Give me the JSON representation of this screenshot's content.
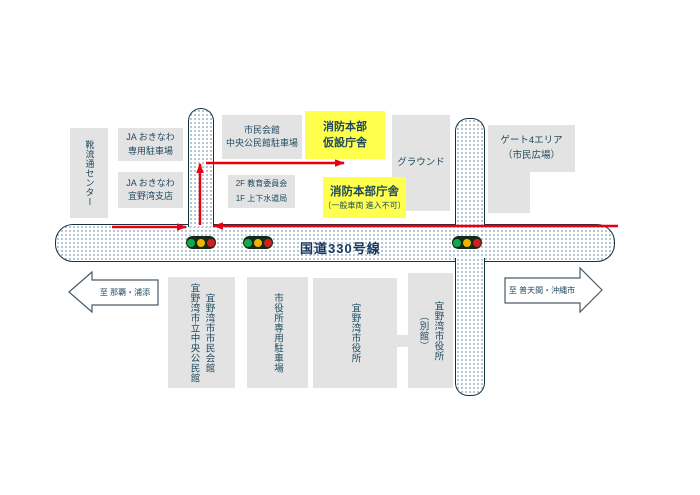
{
  "colors": {
    "highlight_yellow": "#ffff4d",
    "building_gray": "#e3e3e3",
    "route_arrow_red": "#e60012",
    "road_outline": "#16323e",
    "signal_green": "#11a94c",
    "signal_yellow": "#f2b300",
    "signal_red": "#cf1f1f",
    "text_navy": "#1f4a5e"
  },
  "labels": {
    "shoe_center": "靴流通センター",
    "ja_parking_l1": "JA おきなわ",
    "ja_parking_l2": "専用駐車場",
    "ja_branch_l1": "JA おきなわ",
    "ja_branch_l2": "宜野湾支店",
    "civic_hall_parking_l1": "市民会館",
    "civic_hall_parking_l2": "中央公民館駐車場",
    "fire_temp_l1": "消防本部",
    "fire_temp_l2": "仮設庁舎",
    "ground": "グラウンド",
    "gate4_l1": "ゲート4エリア",
    "gate4_l2": "（市民広場）",
    "floors_l1": "2F 教育委員会",
    "floors_l2": "1F 上下水道局",
    "fire_hq_l1": "消防本部庁舎",
    "fire_hq_l2": "（一般車両 進入不可）",
    "route": "国道330号線",
    "to_naha": "至 那覇・浦添",
    "to_futenma": "至 普天間・沖縄市",
    "civic_hall_v1": "宜野湾市市民会館",
    "civic_hall_v2": "宜野湾市立中央公民館",
    "cityhall_parking": "市役所専用駐車場",
    "cityhall": "宜野湾市役所",
    "annex_v1": "宜野湾市役所",
    "annex_v2": "（別館）"
  }
}
